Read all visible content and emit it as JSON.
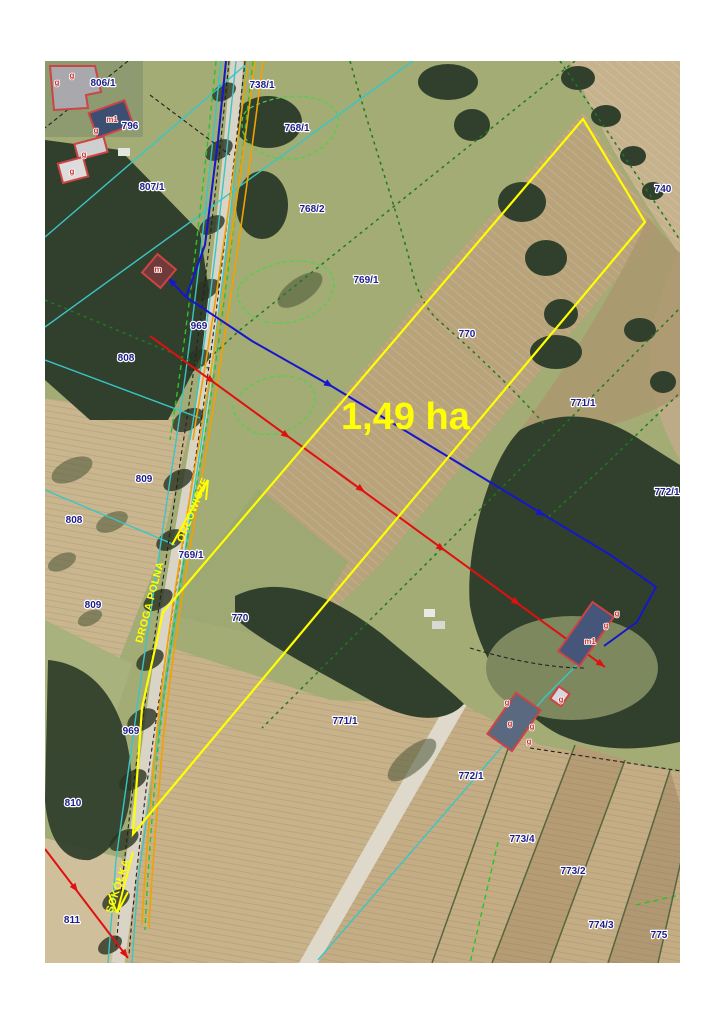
{
  "map": {
    "area_label": {
      "t": "1,49 ha",
      "x": 341,
      "y": 429
    },
    "colors": {
      "highlight_yellow": "#ffff00",
      "red_line": "#e01010",
      "blue_line": "#1616cc",
      "orange_line": "#f2a200",
      "cyan_line": "#38c6c6",
      "green_dashed": "#27c427",
      "dark_green_dashed": "#1f7a1f",
      "parcel_label": "#1c1c8a",
      "building_outline": "#cc4444"
    },
    "parcel_labels": [
      {
        "t": "806/1",
        "x": 103,
        "y": 86
      },
      {
        "t": "796",
        "x": 130,
        "y": 129
      },
      {
        "t": "807/1",
        "x": 152,
        "y": 190
      },
      {
        "t": "738/1",
        "x": 262,
        "y": 88
      },
      {
        "t": "768/1",
        "x": 297,
        "y": 131
      },
      {
        "t": "768/2",
        "x": 312,
        "y": 212
      },
      {
        "t": "740",
        "x": 663,
        "y": 192
      },
      {
        "t": "769/1",
        "x": 366,
        "y": 283
      },
      {
        "t": "770",
        "x": 467,
        "y": 337
      },
      {
        "t": "771/1",
        "x": 583,
        "y": 406
      },
      {
        "t": "772/1",
        "x": 667,
        "y": 495
      },
      {
        "t": "969",
        "x": 199,
        "y": 329
      },
      {
        "t": "808",
        "x": 126,
        "y": 361
      },
      {
        "t": "809",
        "x": 144,
        "y": 482
      },
      {
        "t": "808",
        "x": 74,
        "y": 523
      },
      {
        "t": "769/1",
        "x": 191,
        "y": 558
      },
      {
        "t": "809",
        "x": 93,
        "y": 608
      },
      {
        "t": "770",
        "x": 240,
        "y": 621
      },
      {
        "t": "969",
        "x": 131,
        "y": 734
      },
      {
        "t": "810",
        "x": 73,
        "y": 806
      },
      {
        "t": "811",
        "x": 72,
        "y": 923
      },
      {
        "t": "771/1",
        "x": 345,
        "y": 724
      },
      {
        "t": "772/1",
        "x": 471,
        "y": 779
      },
      {
        "t": "773/4",
        "x": 522,
        "y": 842
      },
      {
        "t": "773/2",
        "x": 573,
        "y": 874
      },
      {
        "t": "774/3",
        "x": 601,
        "y": 928
      },
      {
        "t": "775",
        "x": 659,
        "y": 938
      }
    ],
    "building_labels": [
      {
        "t": "g",
        "x": 57,
        "y": 85
      },
      {
        "t": "g",
        "x": 72,
        "y": 78
      },
      {
        "t": "m1",
        "x": 112,
        "y": 122
      },
      {
        "t": "g",
        "x": 96,
        "y": 133
      },
      {
        "t": "g",
        "x": 84,
        "y": 157
      },
      {
        "t": "g",
        "x": 72,
        "y": 174
      },
      {
        "t": "m",
        "x": 158,
        "y": 272
      },
      {
        "t": "g",
        "x": 617,
        "y": 616
      },
      {
        "t": "g",
        "x": 606,
        "y": 628
      },
      {
        "t": "m1",
        "x": 590,
        "y": 644
      },
      {
        "t": "g",
        "x": 561,
        "y": 702
      },
      {
        "t": "g",
        "x": 507,
        "y": 705
      },
      {
        "t": "g",
        "x": 510,
        "y": 726
      },
      {
        "t": "g",
        "x": 532,
        "y": 729
      },
      {
        "t": "g",
        "x": 529,
        "y": 744
      }
    ],
    "road_labels": [
      {
        "t": "ORŁOWICZE",
        "x": 196,
        "y": 511,
        "r": -68
      },
      {
        "t": "DROGA POLNA",
        "x": 153,
        "y": 603,
        "r": -75
      },
      {
        "t": "SOKÓŁKA",
        "x": 121,
        "y": 887,
        "r": -72
      }
    ]
  }
}
